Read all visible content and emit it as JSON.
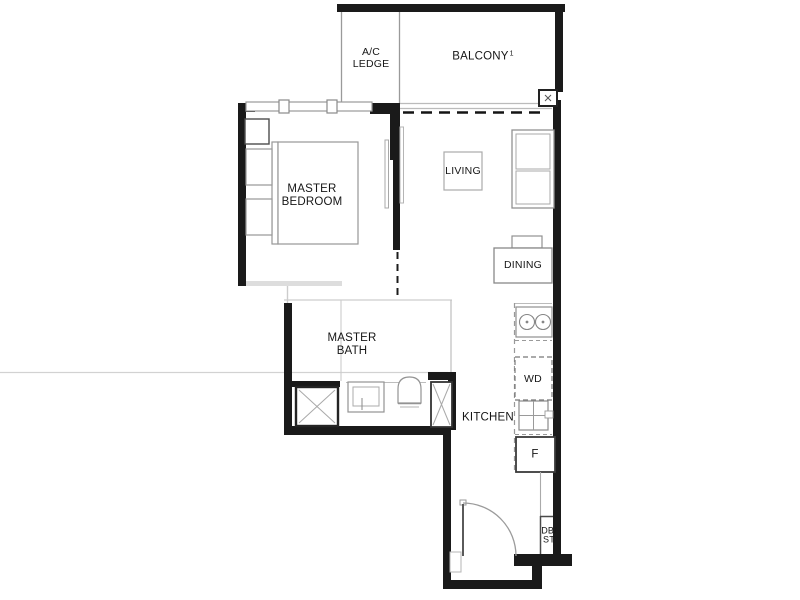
{
  "plan": {
    "title": "1-bedroom unit floor plan",
    "labels": {
      "ac_ledge": {
        "line1": "A/C",
        "line2": "LEDGE"
      },
      "balcony": {
        "text": "BALCONY",
        "sup": "1"
      },
      "master_bedroom": {
        "line1": "MASTER",
        "line2": "BEDROOM"
      },
      "living": {
        "text": "LIVING"
      },
      "dining": {
        "text": "DINING"
      },
      "master_bath": {
        "line1": "MASTER",
        "line2": "BATH"
      },
      "kitchen": {
        "text": "KITCHEN"
      },
      "washer_dryer": {
        "text": "WD"
      },
      "fridge": {
        "text": "F"
      },
      "db_st": {
        "line1": "DB/",
        "line2": "ST"
      }
    },
    "colors": {
      "wall": "#1a1a1a",
      "fixture_outline": "#909090",
      "light_line": "#c9c9c9",
      "dashed_line": "#222222",
      "background": "#ffffff"
    }
  }
}
